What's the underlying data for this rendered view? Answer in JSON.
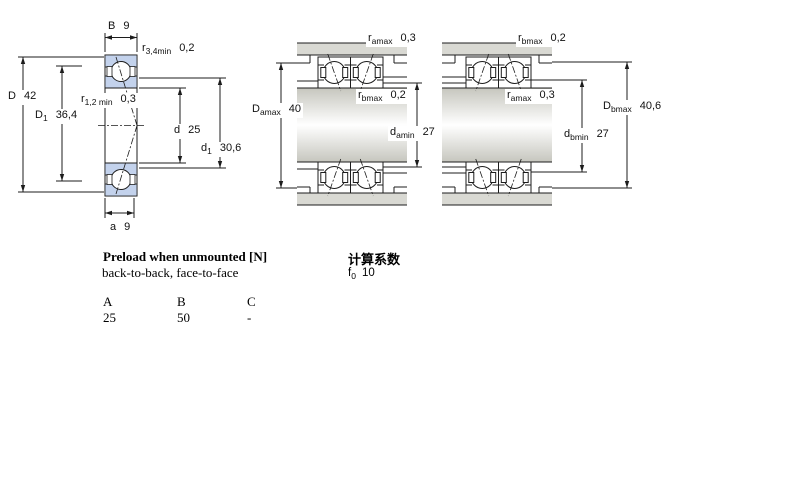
{
  "figures": {
    "bearing_section": {
      "name": "single bearing cross-section",
      "dims": {
        "B": {
          "sym": "B",
          "sub": "",
          "val": "9"
        },
        "r34": {
          "sym": "r",
          "sub": "3,4min",
          "val": "0,2"
        },
        "D": {
          "sym": "D",
          "sub": "",
          "val": "42"
        },
        "D1": {
          "sym": "D",
          "sub": "1",
          "val": "36,4"
        },
        "r12": {
          "sym": "r",
          "sub": "1,2 min",
          "val": "0,3"
        },
        "d": {
          "sym": "d",
          "sub": "",
          "val": "25"
        },
        "d1": {
          "sym": "d",
          "sub": "1",
          "val": "30,6"
        },
        "a": {
          "sym": "a",
          "sub": "",
          "val": "9"
        }
      }
    },
    "back_to_back": {
      "name": "paired mounting, back-to-back",
      "dims": {
        "ramax": {
          "sym": "r",
          "sub": "amax",
          "val": "0,3"
        },
        "Damax": {
          "sym": "D",
          "sub": "amax",
          "val": "40"
        },
        "rbmax": {
          "sym": "r",
          "sub": "bmax",
          "val": "0,2"
        },
        "damin": {
          "sym": "d",
          "sub": "amin",
          "val": "27"
        }
      }
    },
    "face_to_face": {
      "name": "paired mounting, face-to-face",
      "dims": {
        "rbmax": {
          "sym": "r",
          "sub": "bmax",
          "val": "0,2"
        },
        "ramax": {
          "sym": "r",
          "sub": "amax",
          "val": "0,3"
        },
        "Dbmax": {
          "sym": "D",
          "sub": "bmax",
          "val": "40,6"
        },
        "dbmin": {
          "sym": "d",
          "sub": "bmin",
          "val": "27"
        }
      }
    }
  },
  "preload": {
    "heading": "Preload when unmounted [N]",
    "subheading": "back-to-back, face-to-face",
    "columns": [
      "A",
      "B",
      "C"
    ],
    "values": [
      "25",
      "50",
      "-"
    ]
  },
  "calc": {
    "heading": "计算系数",
    "f0": {
      "sym": "f",
      "sub": "0",
      "val": "10"
    }
  },
  "colors": {
    "ring_blue": "#c3d2ec",
    "housing_gray": "#d9d9d3",
    "line": "#1c1c1c"
  }
}
